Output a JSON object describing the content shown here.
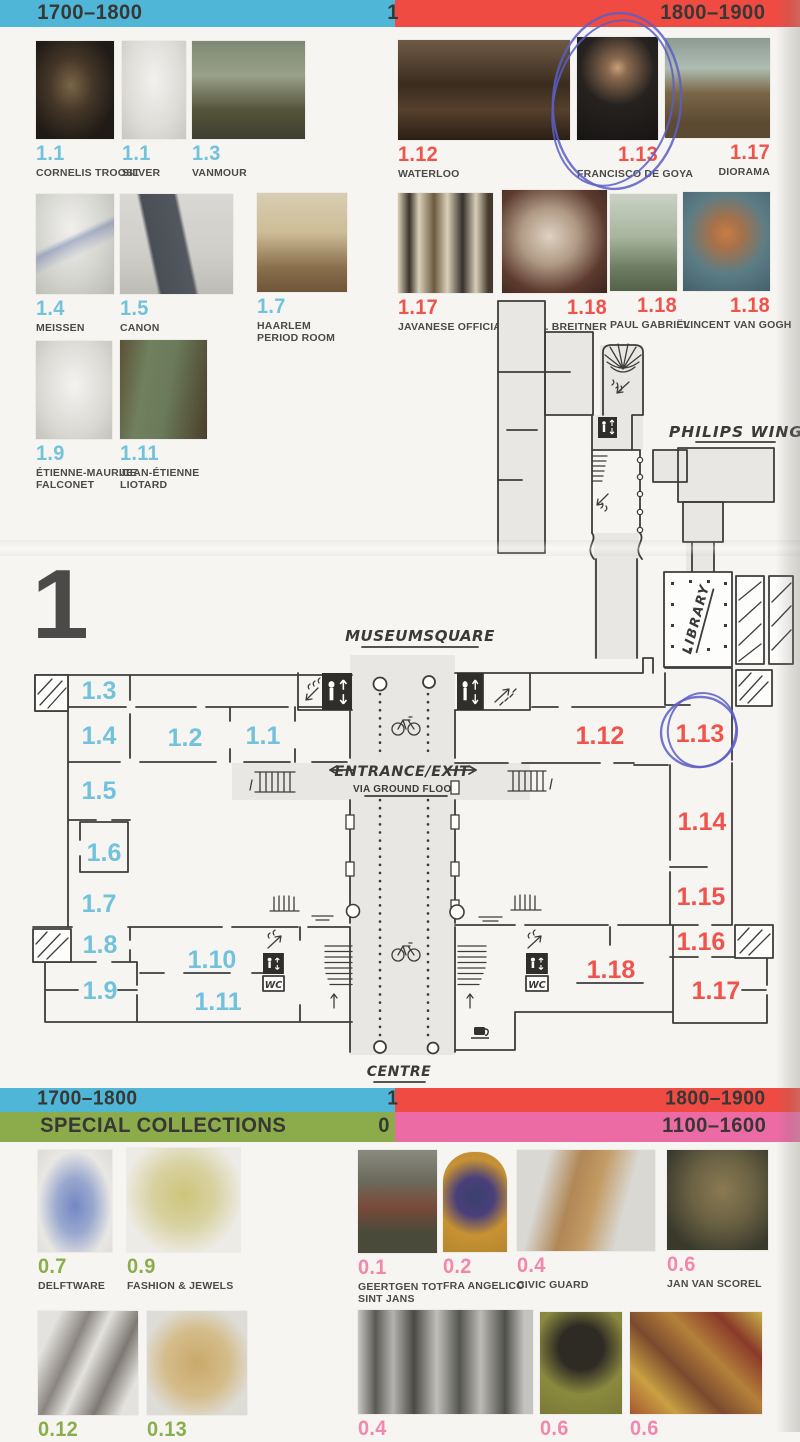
{
  "colors": {
    "cyan": "#50b6d7",
    "red": "#ef4b42",
    "green": "#8cab4b",
    "pink": "#ec6ba5",
    "num_cyan": "#72c2dc",
    "num_red": "#f0534b",
    "num_green": "#8bad4c",
    "num_pink": "#f287ae",
    "ink": "#373736",
    "pen": "#5a5ec6"
  },
  "floor_numeral": "1",
  "bars": {
    "top": {
      "left": "1700–1800",
      "mid": "1",
      "right": "1800–1900"
    },
    "bottom_eras": {
      "left": "1700–1800",
      "mid": "1",
      "right": "1800–1900"
    },
    "special": {
      "left": "SPECIAL COLLECTIONS",
      "mid": "0",
      "right": "1100–1600"
    }
  },
  "top_left": [
    {
      "n": "1.1",
      "l1": "CORNELIS TROOST"
    },
    {
      "n": "1.1",
      "l1": "SILVER"
    },
    {
      "n": "1.3",
      "l1": "VANMOUR"
    },
    {
      "n": "1.4",
      "l1": "MEISSEN"
    },
    {
      "n": "1.5",
      "l1": "CANON"
    },
    {
      "n": "1.7",
      "l1": "HAARLEM",
      "l2": "PERIOD ROOM"
    },
    {
      "n": "1.9",
      "l1": "ÉTIENNE-MAURICE",
      "l2": "FALCONET"
    },
    {
      "n": "1.11",
      "l1": "JEAN-ÉTIENNE",
      "l2": "LIOTARD"
    }
  ],
  "top_right": [
    {
      "n": "1.12",
      "l1": "WATERLOO"
    },
    {
      "n": "1.13",
      "l1": "FRANCISCO DE GOYA"
    },
    {
      "n": "1.17",
      "l1": "DIORAMA"
    },
    {
      "n": "1.17",
      "l1": "JAVANESE OFFICIALS"
    },
    {
      "n": "1.18",
      "l1": "G.H. BREITNER"
    },
    {
      "n": "1.18",
      "l1": "PAUL GABRIËL"
    },
    {
      "n": "1.18",
      "l1": "VINCENT VAN GOGH"
    }
  ],
  "bottom_left": [
    {
      "n": "0.7",
      "l1": "DELFTWARE"
    },
    {
      "n": "0.9",
      "l1": "FASHION & JEWELS"
    },
    {
      "n": "0.12",
      "l1": ""
    },
    {
      "n": "0.13",
      "l1": ""
    }
  ],
  "bottom_right": [
    {
      "n": "0.1",
      "l1": "GEERTGEN TOT",
      "l2": "SINT JANS"
    },
    {
      "n": "0.2",
      "l1": "FRA ANGELICO"
    },
    {
      "n": "0.4",
      "l1": "CIVIC GUARD"
    },
    {
      "n": "0.6",
      "l1": "JAN VAN SCOREL"
    },
    {
      "n": "0.4",
      "l1": ""
    },
    {
      "n": "0.6",
      "l1": ""
    },
    {
      "n": "0.6",
      "l1": ""
    }
  ],
  "plan": {
    "museumsquare": "MUSEUMSQUARE",
    "centre": "CENTRE",
    "philips_wing": "PHILIPS WING",
    "library": "LIBRARY",
    "entrance1": "ENTRANCE/EXIT",
    "entrance2": "VIA GROUND FLOOR",
    "wc": "WC",
    "rooms_west": [
      "1.3",
      "1.4",
      "1.2",
      "1.1",
      "1.5",
      "1.6",
      "1.7",
      "1.8",
      "1.9",
      "1.10",
      "1.11"
    ],
    "rooms_east": [
      "1.12",
      "1.13",
      "1.14",
      "1.15",
      "1.16",
      "1.17",
      "1.18"
    ]
  }
}
